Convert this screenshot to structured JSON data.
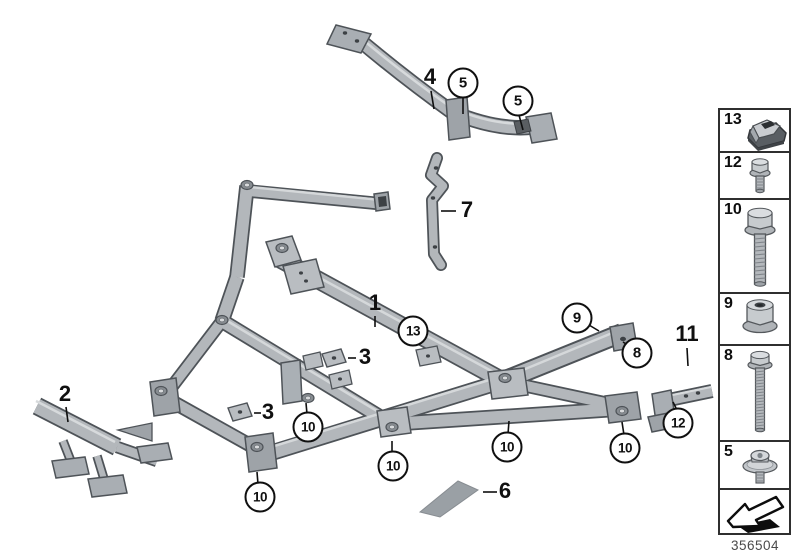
{
  "page": {
    "background": "#ffffff"
  },
  "diagram": {
    "callouts": [
      {
        "label": "5",
        "circled": true,
        "x": 463,
        "y": 83,
        "line": [
          463,
          97,
          463,
          114
        ]
      },
      {
        "label": "5",
        "circled": true,
        "x": 518,
        "y": 101,
        "line": [
          519,
          115,
          523,
          130
        ]
      },
      {
        "label": "13",
        "circled": true,
        "x": 413,
        "y": 331
      },
      {
        "label": "9",
        "circled": true,
        "x": 577,
        "y": 318,
        "line": [
          589,
          325,
          599,
          331
        ]
      },
      {
        "label": "8",
        "circled": true,
        "x": 637,
        "y": 353,
        "line": [
          629,
          346,
          623,
          342
        ]
      },
      {
        "label": "12",
        "circled": true,
        "x": 678,
        "y": 423,
        "line": [
          677,
          410,
          673,
          402
        ]
      },
      {
        "label": "10",
        "circled": true,
        "x": 308,
        "y": 427,
        "line": [
          307,
          414,
          306,
          403
        ]
      },
      {
        "label": "10",
        "circled": true,
        "x": 260,
        "y": 497,
        "line": [
          258,
          484,
          257,
          472
        ]
      },
      {
        "label": "10",
        "circled": true,
        "x": 393,
        "y": 466,
        "line": [
          392,
          453,
          392,
          441
        ]
      },
      {
        "label": "10",
        "circled": true,
        "x": 507,
        "y": 447,
        "line": [
          508,
          434,
          509,
          421
        ]
      },
      {
        "label": "10",
        "circled": true,
        "x": 625,
        "y": 448,
        "line": [
          624,
          435,
          622,
          422
        ]
      },
      {
        "label": "4",
        "circled": false,
        "x": 430,
        "y": 77,
        "line": [
          431,
          91,
          434,
          109
        ]
      },
      {
        "label": "1",
        "circled": false,
        "x": 375,
        "y": 303,
        "line": [
          375,
          316,
          375,
          327
        ]
      },
      {
        "label": "2",
        "circled": false,
        "x": 65,
        "y": 394,
        "line": [
          66,
          407,
          68,
          422
        ]
      },
      {
        "label": "7",
        "circled": false,
        "x": 467,
        "y": 210,
        "line": [
          441,
          211,
          456,
          211
        ]
      },
      {
        "label": "3",
        "circled": false,
        "x": 365,
        "y": 357,
        "line": [
          348,
          358,
          356,
          358
        ]
      },
      {
        "label": "3",
        "circled": false,
        "x": 268,
        "y": 412,
        "line": [
          254,
          413,
          261,
          413
        ]
      },
      {
        "label": "11",
        "circled": false,
        "x": 687,
        "y": 334,
        "line": [
          687,
          348,
          688,
          366
        ]
      },
      {
        "label": "6",
        "circled": false,
        "x": 505,
        "y": 491,
        "line": [
          483,
          492,
          497,
          492
        ]
      }
    ]
  },
  "legend": {
    "items": [
      {
        "number": "13",
        "icon": "clip-nut"
      },
      {
        "number": "12",
        "icon": "flange-bolt-short"
      },
      {
        "number": "10",
        "icon": "flange-bolt"
      },
      {
        "number": "9",
        "icon": "flange-nut"
      },
      {
        "number": "8",
        "icon": "flange-bolt-long"
      },
      {
        "number": "5",
        "icon": "washer-screw"
      }
    ],
    "footer_icon": "direction-arrow",
    "part_number": "356504"
  },
  "colors": {
    "ink": "#101010",
    "legend_border": "#2f2f2f",
    "part_number_color": "#4a4a4a",
    "metal": "#b3b7bb",
    "metal_shade": "#8f959a",
    "metal_light": "#d7dadc",
    "outline": "#4e5358"
  }
}
